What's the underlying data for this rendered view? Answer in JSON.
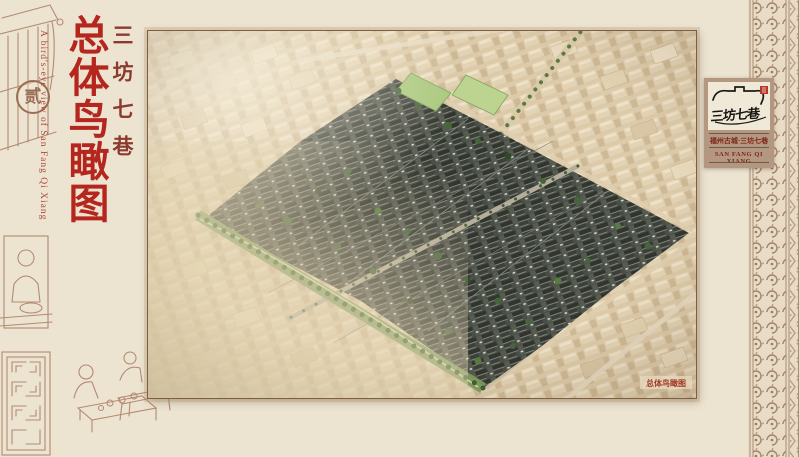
{
  "page": {
    "page_number": "贰"
  },
  "title_block": {
    "series_title": "三坊七巷",
    "main_title": "总体鸟瞰图",
    "english_title": "A bird's-eye view of San Fang Qi Xiang"
  },
  "main_image": {
    "caption": "总体鸟瞰图"
  },
  "brand_card": {
    "logo_text": "三坊七巷",
    "location_line": "福州古城·三坊七巷",
    "english_line": "SAN FANG QI XIANG"
  },
  "icons": {
    "page_number_badge": "circled-character",
    "seal_stamp": "red-square-seal",
    "roofline_logo": "eave-silhouette",
    "left_margin_art": "woodblock-sketches",
    "border_ornament": "lattice-scroll-band"
  },
  "colors": {
    "background": "#ece4d1",
    "title_red": "#b4261e",
    "series_red": "#8c3a30",
    "english_red": "#b0483a",
    "sketch_sienna": "#a6745b",
    "card_taupe": "#b39780",
    "card_text_red": "#7d241a",
    "seal_red": "#b8372a",
    "roof_dark": "#454a43",
    "city_beige": "#dbc8a8",
    "foliage_green": "#45663a"
  }
}
